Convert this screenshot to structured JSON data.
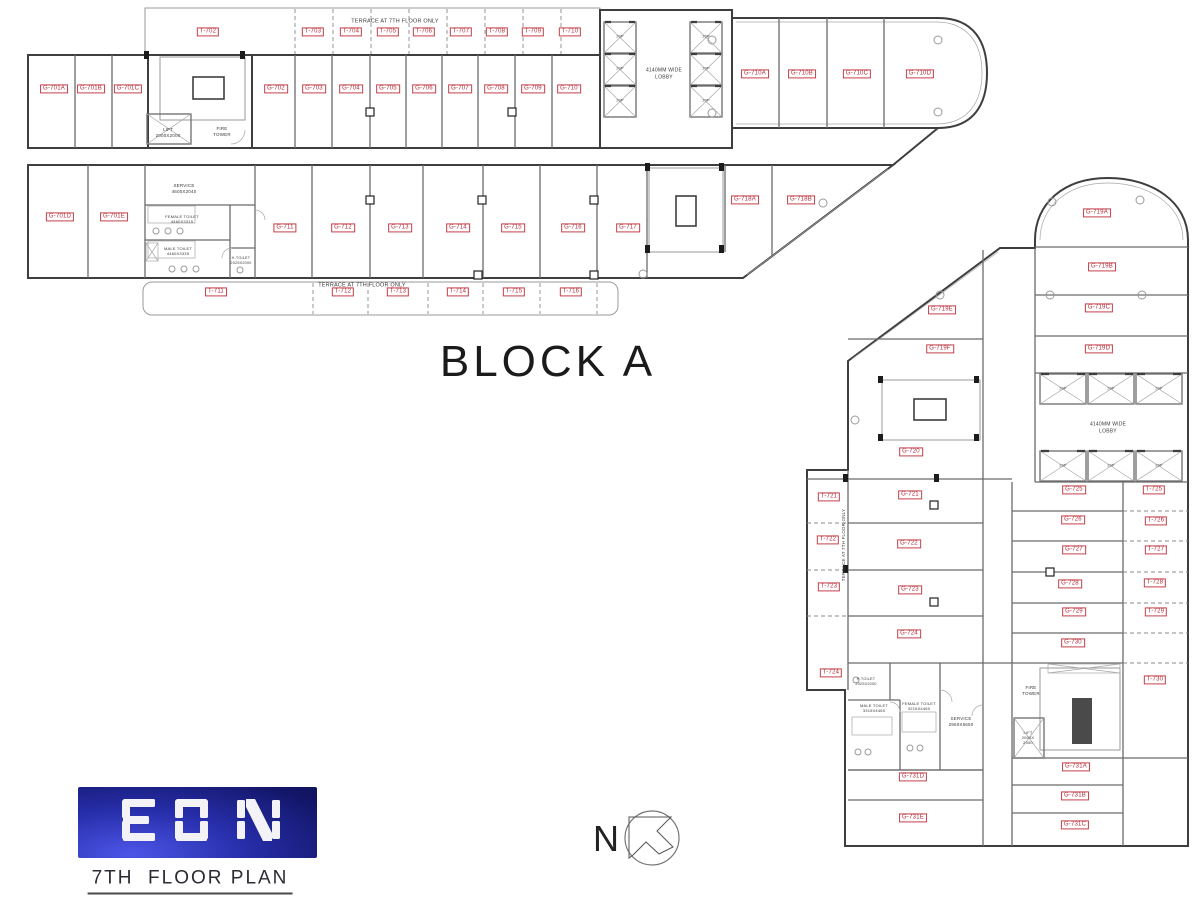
{
  "title": {
    "block": "BLOCK A",
    "floor": "7TH  FLOOR PLAN",
    "logo": "EON",
    "north": "N"
  },
  "colors": {
    "label_red": "#b02a36",
    "wall_gray": "#3e3e3e",
    "logo_blue": "#1b1f9a"
  },
  "room_labels": [
    {
      "id": "T-702",
      "x": 208,
      "y": 32
    },
    {
      "id": "T-703",
      "x": 313,
      "y": 32
    },
    {
      "id": "T-704",
      "x": 351,
      "y": 32
    },
    {
      "id": "T-705",
      "x": 388,
      "y": 32
    },
    {
      "id": "T-706",
      "x": 424,
      "y": 32
    },
    {
      "id": "T-707",
      "x": 461,
      "y": 32
    },
    {
      "id": "T-708",
      "x": 497,
      "y": 32
    },
    {
      "id": "T-709",
      "x": 533,
      "y": 32
    },
    {
      "id": "T-710",
      "x": 570,
      "y": 32
    },
    {
      "id": "G-701A",
      "x": 54,
      "y": 89
    },
    {
      "id": "G-701B",
      "x": 91,
      "y": 89
    },
    {
      "id": "G-701C",
      "x": 128,
      "y": 89
    },
    {
      "id": "G-702",
      "x": 276,
      "y": 89
    },
    {
      "id": "G-703",
      "x": 314,
      "y": 89
    },
    {
      "id": "G-704",
      "x": 351,
      "y": 89
    },
    {
      "id": "G-705",
      "x": 388,
      "y": 89
    },
    {
      "id": "G-706",
      "x": 424,
      "y": 89
    },
    {
      "id": "G-707",
      "x": 460,
      "y": 89
    },
    {
      "id": "G-708",
      "x": 496,
      "y": 89
    },
    {
      "id": "G-709",
      "x": 533,
      "y": 89
    },
    {
      "id": "G-710",
      "x": 569,
      "y": 89
    },
    {
      "id": "G-710A",
      "x": 755,
      "y": 74
    },
    {
      "id": "G-710B",
      "x": 802,
      "y": 74
    },
    {
      "id": "G-710C",
      "x": 857,
      "y": 74
    },
    {
      "id": "G-710D",
      "x": 920,
      "y": 74
    },
    {
      "id": "G-701D",
      "x": 60,
      "y": 217
    },
    {
      "id": "G-701E",
      "x": 114,
      "y": 217
    },
    {
      "id": "G-711",
      "x": 285,
      "y": 228
    },
    {
      "id": "G-712",
      "x": 343,
      "y": 228
    },
    {
      "id": "G-713",
      "x": 400,
      "y": 228
    },
    {
      "id": "G-714",
      "x": 458,
      "y": 228
    },
    {
      "id": "G-715",
      "x": 513,
      "y": 228
    },
    {
      "id": "G-716",
      "x": 573,
      "y": 228
    },
    {
      "id": "G-717",
      "x": 628,
      "y": 228
    },
    {
      "id": "G-718A",
      "x": 745,
      "y": 200
    },
    {
      "id": "G-718B",
      "x": 801,
      "y": 200
    },
    {
      "id": "T-711",
      "x": 216,
      "y": 292
    },
    {
      "id": "T-712",
      "x": 343,
      "y": 292
    },
    {
      "id": "T-713",
      "x": 398,
      "y": 292
    },
    {
      "id": "T-714",
      "x": 458,
      "y": 292
    },
    {
      "id": "T-715",
      "x": 514,
      "y": 292
    },
    {
      "id": "T-716",
      "x": 571,
      "y": 292
    },
    {
      "id": "G-719A",
      "x": 1097,
      "y": 213
    },
    {
      "id": "G-719B",
      "x": 1102,
      "y": 267
    },
    {
      "id": "G-719C",
      "x": 1099,
      "y": 308
    },
    {
      "id": "G-719D",
      "x": 1099,
      "y": 349
    },
    {
      "id": "G-719E",
      "x": 942,
      "y": 310
    },
    {
      "id": "G-719F",
      "x": 940,
      "y": 349
    },
    {
      "id": "G-720",
      "x": 911,
      "y": 452
    },
    {
      "id": "G-721",
      "x": 910,
      "y": 495
    },
    {
      "id": "G-722",
      "x": 909,
      "y": 544
    },
    {
      "id": "G-723",
      "x": 910,
      "y": 590
    },
    {
      "id": "G-724",
      "x": 909,
      "y": 634
    },
    {
      "id": "T-721",
      "x": 829,
      "y": 497
    },
    {
      "id": "T-722",
      "x": 828,
      "y": 540
    },
    {
      "id": "T-723",
      "x": 829,
      "y": 587
    },
    {
      "id": "T-724",
      "x": 831,
      "y": 673
    },
    {
      "id": "G-725",
      "x": 1074,
      "y": 490
    },
    {
      "id": "G-726",
      "x": 1073,
      "y": 520
    },
    {
      "id": "G-727",
      "x": 1074,
      "y": 550
    },
    {
      "id": "G-728",
      "x": 1070,
      "y": 584
    },
    {
      "id": "G-729",
      "x": 1074,
      "y": 612
    },
    {
      "id": "G-730",
      "x": 1073,
      "y": 643
    },
    {
      "id": "T-725",
      "x": 1154,
      "y": 490
    },
    {
      "id": "T-726",
      "x": 1156,
      "y": 521
    },
    {
      "id": "T-727",
      "x": 1156,
      "y": 550
    },
    {
      "id": "T-728",
      "x": 1155,
      "y": 583
    },
    {
      "id": "T-729",
      "x": 1156,
      "y": 612
    },
    {
      "id": "T-730",
      "x": 1155,
      "y": 680
    },
    {
      "id": "G-731A",
      "x": 1076,
      "y": 767
    },
    {
      "id": "G-731B",
      "x": 1075,
      "y": 796
    },
    {
      "id": "G-731C",
      "x": 1075,
      "y": 825
    },
    {
      "id": "G-731D",
      "x": 913,
      "y": 777
    },
    {
      "id": "G-731E",
      "x": 913,
      "y": 818
    }
  ],
  "annotations": [
    {
      "text": "TERRACE AT 7TH FLOOR ONLY",
      "x": 395,
      "y": 22,
      "size": 5.5
    },
    {
      "text": "LIFT\n2000X2000",
      "x": 168,
      "y": 133,
      "size": 4.5
    },
    {
      "text": "FIRE\nTOWER",
      "x": 222,
      "y": 132,
      "size": 4.5
    },
    {
      "text": "4140MM WIDE\nLOBBY",
      "x": 664,
      "y": 74,
      "size": 5
    },
    {
      "text": "SERVICE\n4600X2040",
      "x": 184,
      "y": 189,
      "size": 4.5
    },
    {
      "text": "FEMALE TOILET\n4460X3315",
      "x": 182,
      "y": 219,
      "size": 4
    },
    {
      "text": "MALE TOILET\n4460X3335",
      "x": 178,
      "y": 251,
      "size": 4
    },
    {
      "text": "H.TOILET\n2025X2000",
      "x": 241,
      "y": 261,
      "size": 3.8
    },
    {
      "text": "TERRACE AT 7TH FLOOR ONLY",
      "x": 362,
      "y": 286,
      "size": 5.5
    },
    {
      "text": "4140MM WIDE\nLOBBY",
      "x": 1108,
      "y": 428,
      "size": 5
    },
    {
      "text": "TERRACE AT 7TH FLOOR ONLY",
      "x": 844,
      "y": 545,
      "size": 4.5,
      "rot": -90
    },
    {
      "text": "H.TOILET\n2025X2000",
      "x": 866,
      "y": 682,
      "size": 3.8
    },
    {
      "text": "MALE TOILET\n3315X4460",
      "x": 874,
      "y": 708,
      "size": 4
    },
    {
      "text": "FEMALE TOILET\n3215X4460",
      "x": 919,
      "y": 706,
      "size": 4
    },
    {
      "text": "SERVICE\n2960X5650",
      "x": 961,
      "y": 722,
      "size": 4.5
    },
    {
      "text": "FIRE\nTOWER",
      "x": 1031,
      "y": 691,
      "size": 4.5
    },
    {
      "text": "LIFT\n2000X\n2000",
      "x": 1028,
      "y": 738,
      "size": 4
    },
    {
      "text": "20P",
      "x": 620,
      "y": 37,
      "size": 3.8
    },
    {
      "text": "20P",
      "x": 620,
      "y": 69,
      "size": 3.8
    },
    {
      "text": "20P",
      "x": 620,
      "y": 101,
      "size": 3.8
    },
    {
      "text": "20P",
      "x": 706,
      "y": 37,
      "size": 3.8
    },
    {
      "text": "20P",
      "x": 706,
      "y": 69,
      "size": 3.8
    },
    {
      "text": "20P",
      "x": 706,
      "y": 101,
      "size": 3.8
    },
    {
      "text": "20P",
      "x": 1063,
      "y": 389,
      "size": 3.8
    },
    {
      "text": "20P",
      "x": 1111,
      "y": 389,
      "size": 3.8
    },
    {
      "text": "20P",
      "x": 1159,
      "y": 389,
      "size": 3.8
    },
    {
      "text": "20P",
      "x": 1063,
      "y": 466,
      "size": 3.8
    },
    {
      "text": "20P",
      "x": 1111,
      "y": 466,
      "size": 3.8
    },
    {
      "text": "20P",
      "x": 1159,
      "y": 466,
      "size": 3.8
    }
  ]
}
